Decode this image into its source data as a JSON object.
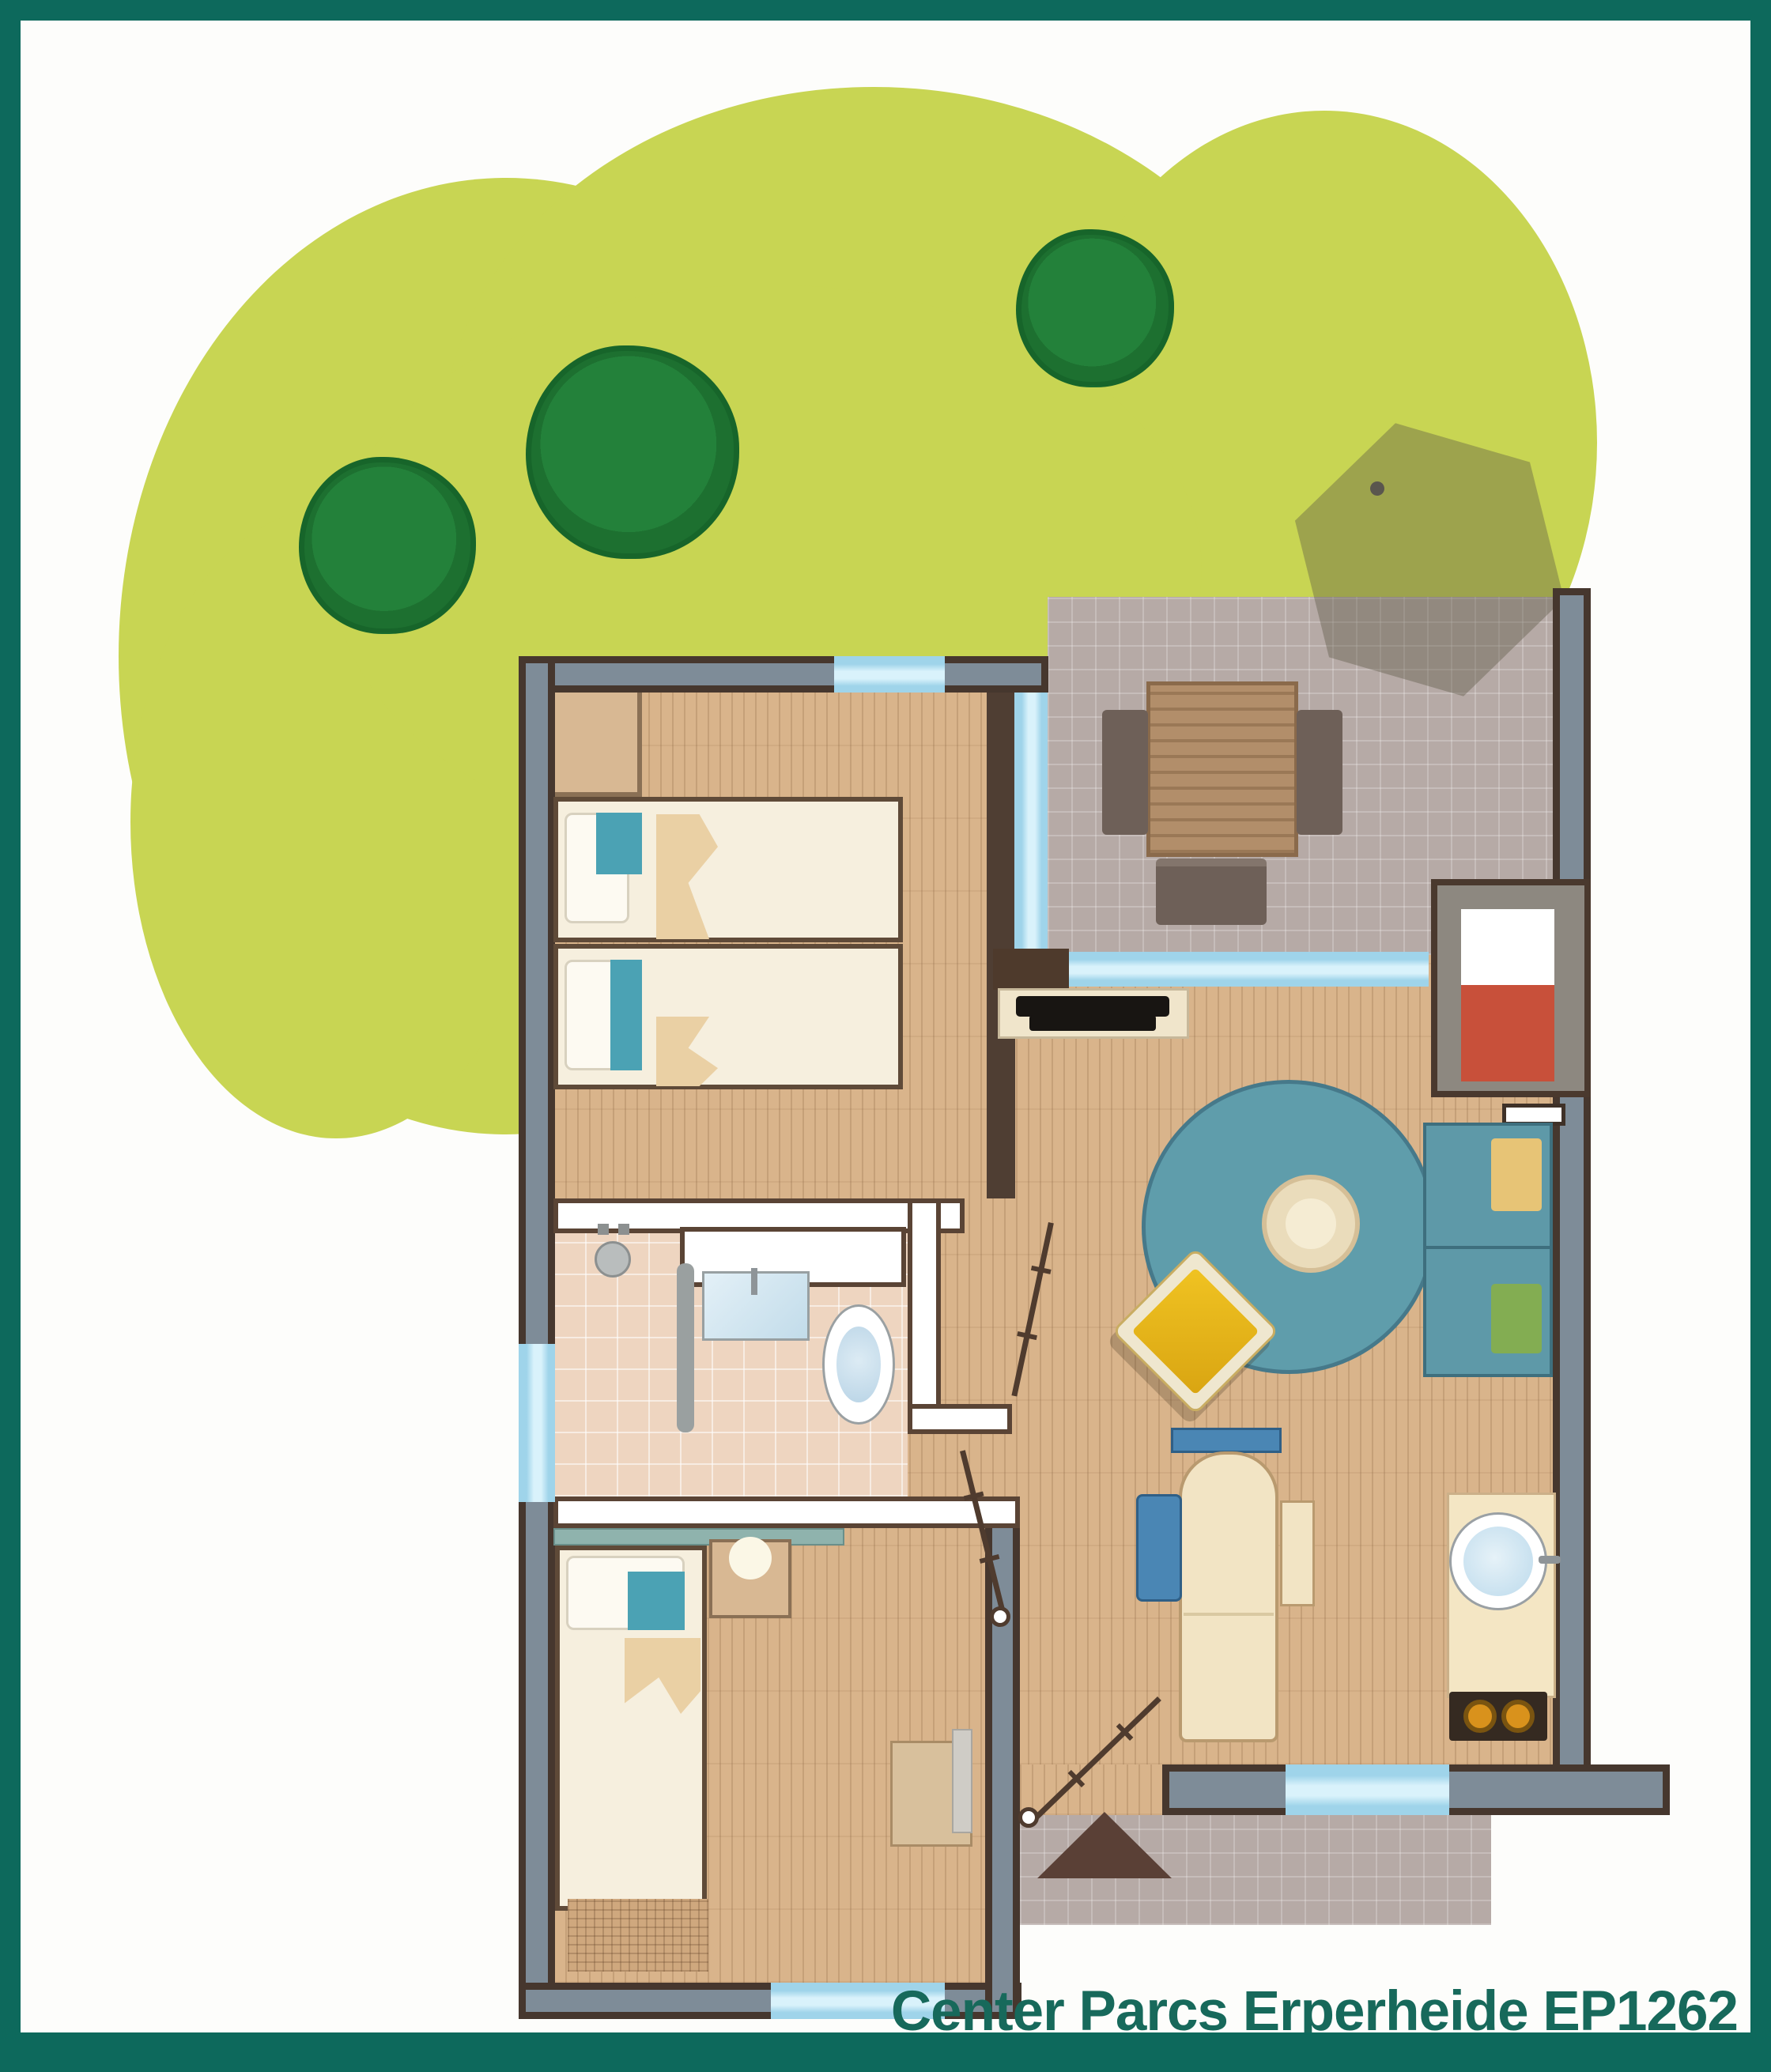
{
  "caption": {
    "text": "Center Parcs Erperheide EP1262"
  },
  "colors": {
    "frame": "#0d695c",
    "caption_text": "#17695b",
    "background": "#fdfdfb",
    "grass": "#c8d553",
    "tree": "#207c34",
    "patio_tile": "#b6aaa6",
    "wood_floor": "#d9b48b",
    "bathroom_tile": "#eed5c0",
    "wall_core": "#7e8c98",
    "wall_edge": "#46372e",
    "interior_wall": "#ffffff",
    "window_glass": "#a5dcf0",
    "rug": "#5f9dab",
    "sofa": "#5e99a8",
    "armchair_yellow": "#ecb91e",
    "fireplace_red": "#c8503a",
    "dining_chair_blue": "#4a86b4",
    "stove_burner": "#d9921c",
    "bed_mattress": "#f6efde",
    "pillow_accent": "#4ba2b4",
    "umbrella": "#f8f6ee"
  },
  "icons": [
    "tree-icon",
    "parasol-icon",
    "picnic-table-icon",
    "fireplace-icon",
    "tv-icon",
    "round-rug-icon",
    "coffee-table-icon",
    "armchair-icon",
    "sofa-icon",
    "twin-bed-icon",
    "single-bed-icon",
    "wardrobe-icon",
    "shower-icon",
    "washbasin-icon",
    "toilet-icon",
    "dining-table-icon",
    "bench-icon",
    "kitchen-sink-icon",
    "stove-icon",
    "lamp-icon",
    "door-swing-icon",
    "entrance-arrow-icon",
    "window-icon"
  ]
}
